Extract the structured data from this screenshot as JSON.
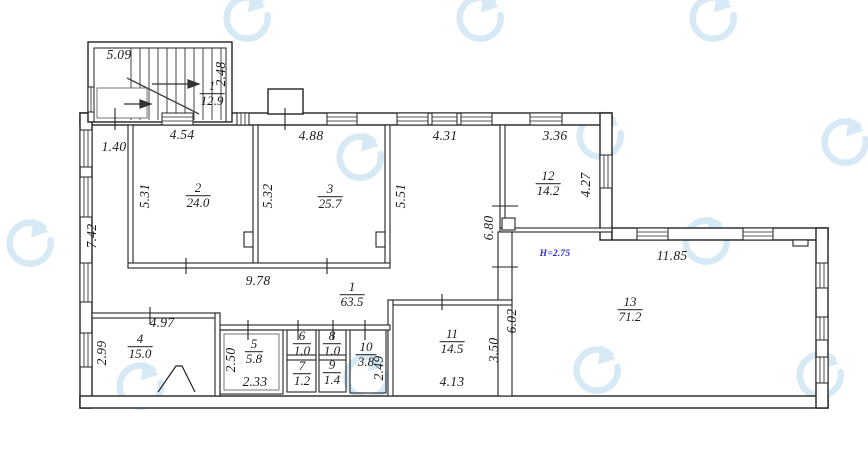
{
  "plan": {
    "height_label": "Н=2.75",
    "rooms": {
      "stairwell": {
        "number": "1",
        "area": "12.9"
      },
      "corridor": {
        "number": "1",
        "area": "63.5"
      },
      "r2": {
        "number": "2",
        "area": "24.0"
      },
      "r3": {
        "number": "3",
        "area": "25.7"
      },
      "r4": {
        "number": "4",
        "area": "15.0"
      },
      "r5": {
        "number": "5",
        "area": "5.8"
      },
      "r6": {
        "number": "6",
        "area": "1.0"
      },
      "r7": {
        "number": "7",
        "area": "1.2"
      },
      "r8": {
        "number": "8",
        "area": "1.0"
      },
      "r9": {
        "number": "9",
        "area": "1.4"
      },
      "r10": {
        "number": "10",
        "area": "3.8"
      },
      "r11": {
        "number": "11",
        "area": "14.5"
      },
      "r12": {
        "number": "12",
        "area": "14.2"
      },
      "r13": {
        "number": "13",
        "area": "71.2"
      }
    },
    "dimensions": {
      "stair_width": "5.09",
      "stair_depth": "2.48",
      "entry_w": "1.40",
      "r2_w": "4.54",
      "r3_w": "4.88",
      "hall_w": "4.31",
      "r12_w": "3.36",
      "left_wall_h": "7.42",
      "r2_h": "5.31",
      "r3_h": "5.32",
      "hall_h": "5.51",
      "r12_h": "4.27",
      "corr_h": "6.80",
      "corr_w": "9.78",
      "r13_w": "11.85",
      "r13_h": "6.02",
      "r4_w": "4.97",
      "r4_h": "2.99",
      "r5_h": "2.50",
      "r5_w": "2.33",
      "r10_h": "2.49",
      "r11_h": "3.50",
      "r11_w": "4.13"
    },
    "colors": {
      "wall": "#222222",
      "watermark": "#b9d7ee",
      "height_note": "#2b2bd0"
    }
  }
}
